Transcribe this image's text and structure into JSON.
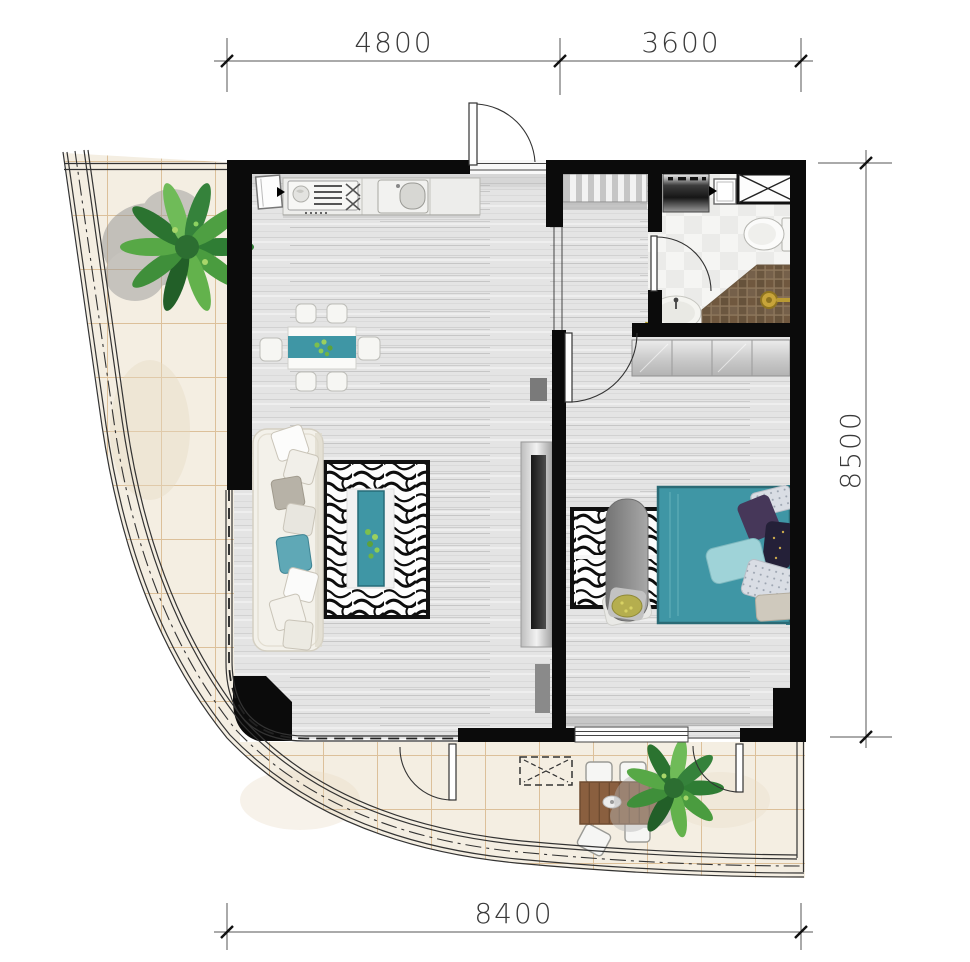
{
  "title": "apartment-floor-plan",
  "dimensions": {
    "top": [
      {
        "label": "4800"
      },
      {
        "label": "3600"
      }
    ],
    "right": {
      "label": "8500"
    },
    "bottom": {
      "label": "8400"
    }
  },
  "icons": {
    "stove": "cooktop-burners-icon",
    "sink": "kitchen-sink-icon",
    "toilet": "toilet-icon",
    "shower": "shower-head-icon",
    "washer": "washing-machine-icon",
    "duct": "shaft-cross-icon",
    "ac": "ac-outdoor-unit-dashed-icon"
  },
  "colors": {
    "wall": "#0b0b0b",
    "teal": "#3f96a5",
    "teal_dark": "#2b6c77",
    "teal_light": "#9fd3d8",
    "wood_floor": "#e3e3e3",
    "balcony_tile": "#f4eee2",
    "tile_grout": "#d9ba90",
    "bath_tile": "#f4f4f2",
    "shower_brown": "#6b5740",
    "gold": "#c7a43a",
    "plant_green": "#3f8f3f",
    "outdoor_wood": "#8a5f3f",
    "sofa_cream": "#f3f1ea",
    "bench_gray": "#8d8d8d",
    "dim_line": "#555555",
    "dim_text": "#3a3a3a"
  }
}
